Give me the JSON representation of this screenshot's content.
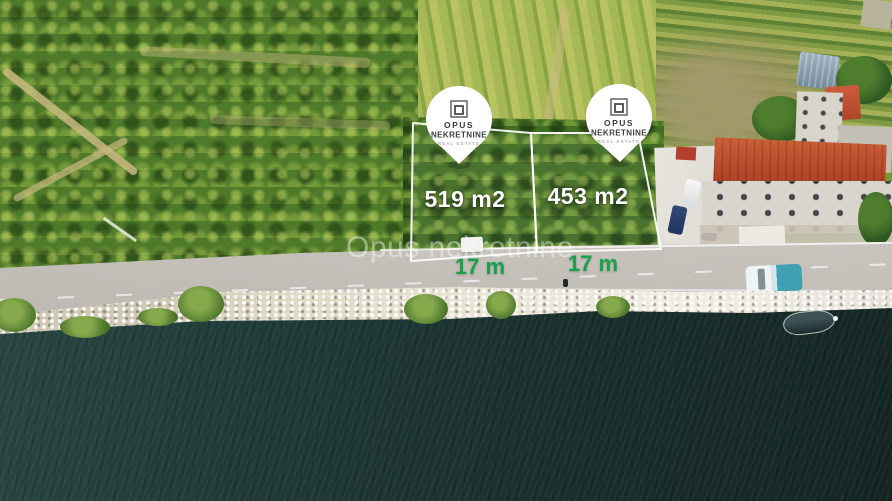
{
  "photo": {
    "watermark_text": "Opus nekretnine"
  },
  "pins": [
    {
      "brand_top": "OPUS",
      "brand_bottom": "NEKRETNINE",
      "subtitle": "REAL ESTATE"
    },
    {
      "brand_top": "OPUS",
      "brand_bottom": "NEKRETNINE",
      "subtitle": "REAL ESTATE"
    }
  ],
  "plots": [
    {
      "area_label": "519 m2",
      "width_label": "17 m"
    },
    {
      "area_label": "453 m2",
      "width_label": "17 m"
    }
  ],
  "colors": {
    "width_label_green": "#18a24c",
    "area_label_white": "#ffffff",
    "boundary_line": "#ffffff",
    "pin_background": "#ffffff",
    "pin_text": "#3d3d3d",
    "pin_subtitle": "#8f8f8f",
    "road_grey": "#bdbab3",
    "water_dark": "#1c3533",
    "orchard_green": "#4e7a2a",
    "roof_red": "#b84a2a"
  }
}
